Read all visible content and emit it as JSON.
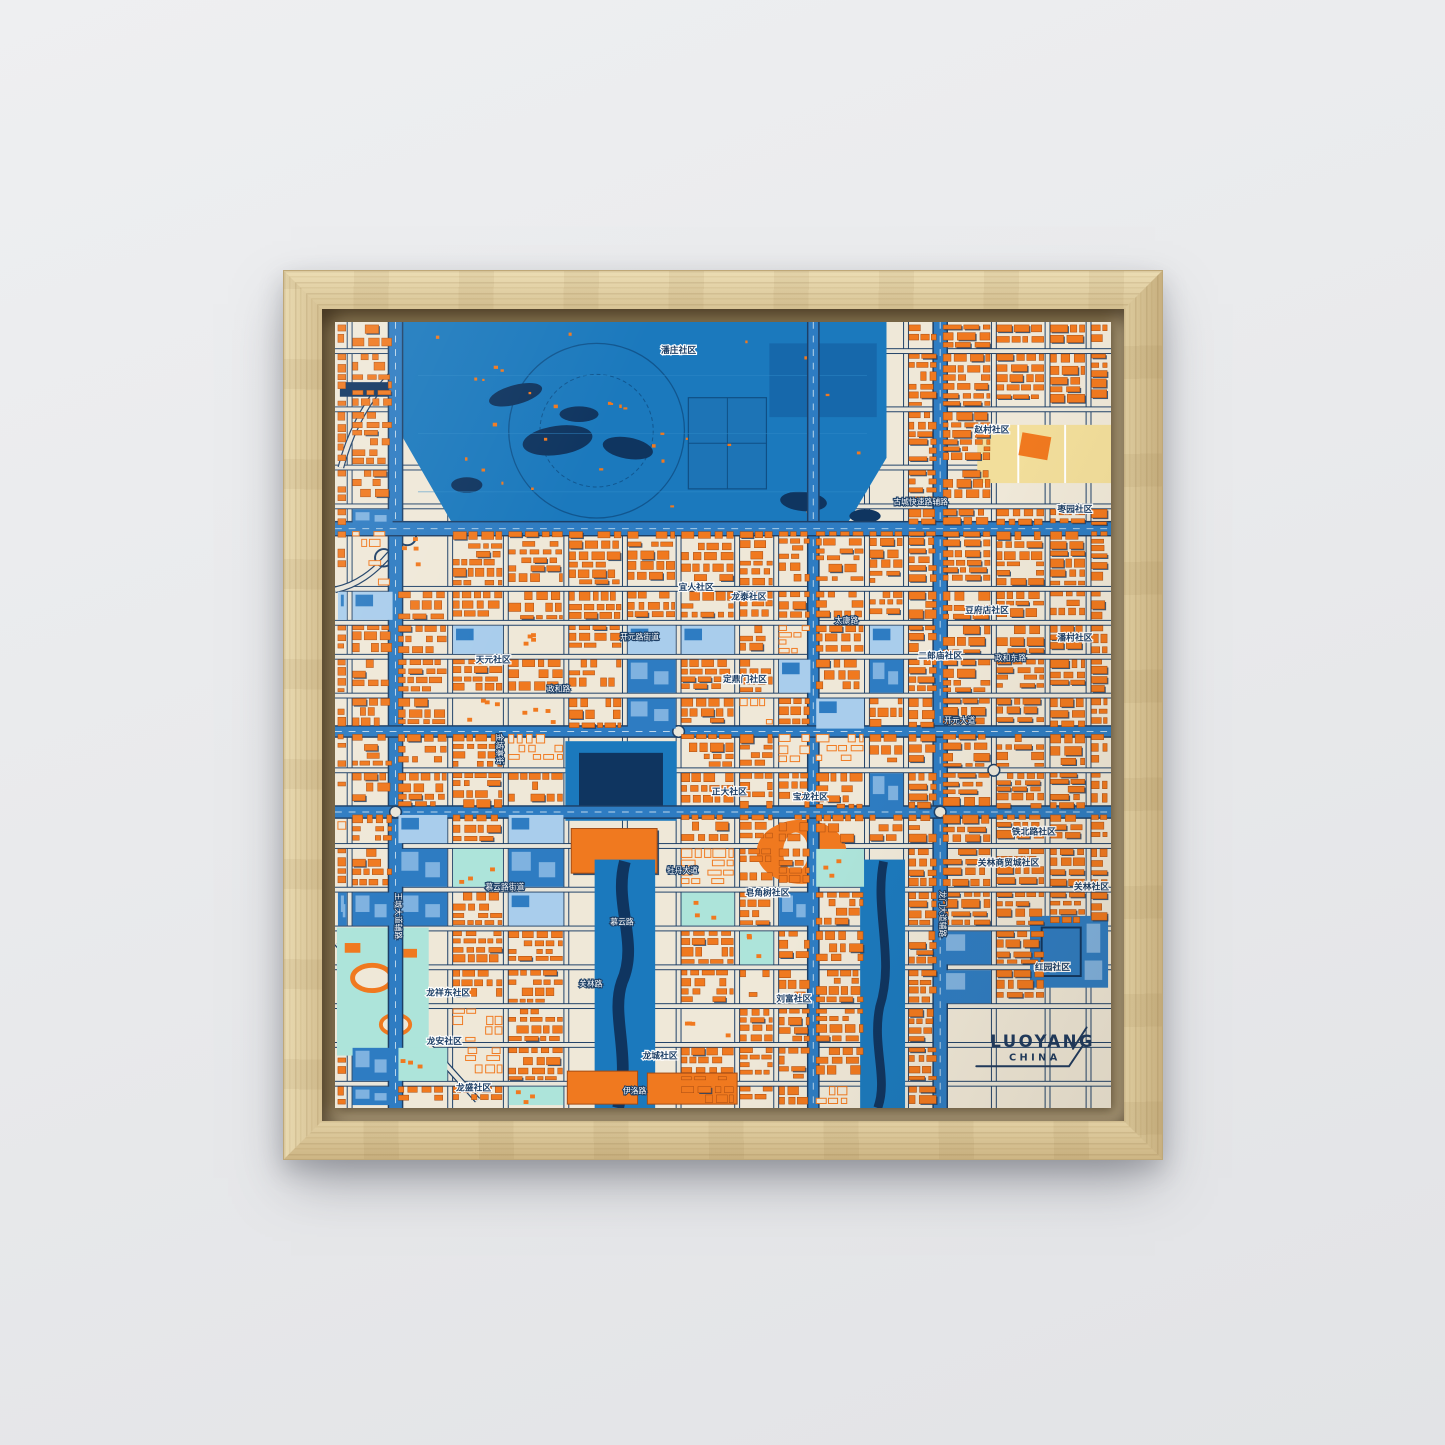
{
  "artwork": {
    "title": "LUOYANG",
    "subtitle": "CHINA"
  },
  "map_labels": [
    {
      "text": "潘庄社区",
      "x": 352,
      "y": 32,
      "kind": "district"
    },
    {
      "text": "赵村社区",
      "x": 673,
      "y": 114,
      "kind": "district"
    },
    {
      "text": "枣园社区",
      "x": 758,
      "y": 196,
      "kind": "district"
    },
    {
      "text": "古城快速路辅路",
      "x": 600,
      "y": 188,
      "kind": "road"
    },
    {
      "text": "宜人社区",
      "x": 370,
      "y": 276,
      "kind": "district"
    },
    {
      "text": "龙泰社区",
      "x": 424,
      "y": 286,
      "kind": "district"
    },
    {
      "text": "开元路街道",
      "x": 312,
      "y": 327,
      "kind": "road"
    },
    {
      "text": "太康路",
      "x": 524,
      "y": 310,
      "kind": "road"
    },
    {
      "text": "豆府店社区",
      "x": 668,
      "y": 300,
      "kind": "district"
    },
    {
      "text": "潘村社区",
      "x": 758,
      "y": 328,
      "kind": "district"
    },
    {
      "text": "二郎庙社区",
      "x": 620,
      "y": 347,
      "kind": "district"
    },
    {
      "text": "政和东路",
      "x": 692,
      "y": 349,
      "kind": "road"
    },
    {
      "text": "天元社区",
      "x": 162,
      "y": 351,
      "kind": "district"
    },
    {
      "text": "政和路",
      "x": 229,
      "y": 381,
      "kind": "road"
    },
    {
      "text": "定鼎门社区",
      "x": 420,
      "y": 371,
      "kind": "district"
    },
    {
      "text": "开元大道",
      "x": 640,
      "y": 413,
      "kind": "road"
    },
    {
      "text": "正大社区",
      "x": 404,
      "y": 487,
      "kind": "district"
    },
    {
      "text": "宝龙社区",
      "x": 487,
      "y": 492,
      "kind": "district"
    },
    {
      "text": "牡丹大道",
      "x": 356,
      "y": 568,
      "kind": "road"
    },
    {
      "text": "皂角树社区",
      "x": 443,
      "y": 591,
      "kind": "district"
    },
    {
      "text": "慕云路街道",
      "x": 174,
      "y": 585,
      "kind": "road"
    },
    {
      "text": "慕云路",
      "x": 294,
      "y": 621,
      "kind": "road"
    },
    {
      "text": "关林路",
      "x": 262,
      "y": 685,
      "kind": "road"
    },
    {
      "text": "龙祥东社区",
      "x": 116,
      "y": 694,
      "kind": "district"
    },
    {
      "text": "龙安社区",
      "x": 112,
      "y": 744,
      "kind": "district"
    },
    {
      "text": "龙盛社区",
      "x": 142,
      "y": 792,
      "kind": "district"
    },
    {
      "text": "龙城社区",
      "x": 333,
      "y": 759,
      "kind": "district"
    },
    {
      "text": "铁北路社区",
      "x": 716,
      "y": 528,
      "kind": "district"
    },
    {
      "text": "关林商贸城社区",
      "x": 690,
      "y": 560,
      "kind": "district"
    },
    {
      "text": "关林社区",
      "x": 775,
      "y": 585,
      "kind": "district"
    },
    {
      "text": "刘富社区",
      "x": 470,
      "y": 700,
      "kind": "district"
    },
    {
      "text": "红园社区",
      "x": 735,
      "y": 668,
      "kind": "district"
    },
    {
      "text": "伊洛路",
      "x": 307,
      "y": 795,
      "kind": "road"
    },
    {
      "text": "王城大道辅路",
      "x": 62,
      "y": 612,
      "kind": "road",
      "rot": 90
    },
    {
      "text": "金城寨街",
      "x": 166,
      "y": 440,
      "kind": "road",
      "rot": 90
    },
    {
      "text": "龙门大道辅路",
      "x": 620,
      "y": 610,
      "kind": "road",
      "rot": 90
    }
  ],
  "colors": {
    "wall": "#e9eaec",
    "frame_wood": "#dcc99c",
    "map_background": "#efe8d8",
    "park_blue": "#1b79bd",
    "park_blue_dark": "#1565a8",
    "water_navy": "#0f3560",
    "road_casing_navy": "#1d3f66",
    "road_fill_pale": "#eae6da",
    "avenue_blue": "#2e7cc2",
    "avenue_dash": "#bcd6ea",
    "building_orange": "#f0791f",
    "building_outline": "#a34a12",
    "building_shadow": "#1d3f66",
    "block_blue_light": "#7fb2e0",
    "park_cyan": "#ade4da",
    "block_lightblue": "#a9cdec",
    "block_yellow": "#f2de9b",
    "title_navy": "#1e3a5f"
  }
}
